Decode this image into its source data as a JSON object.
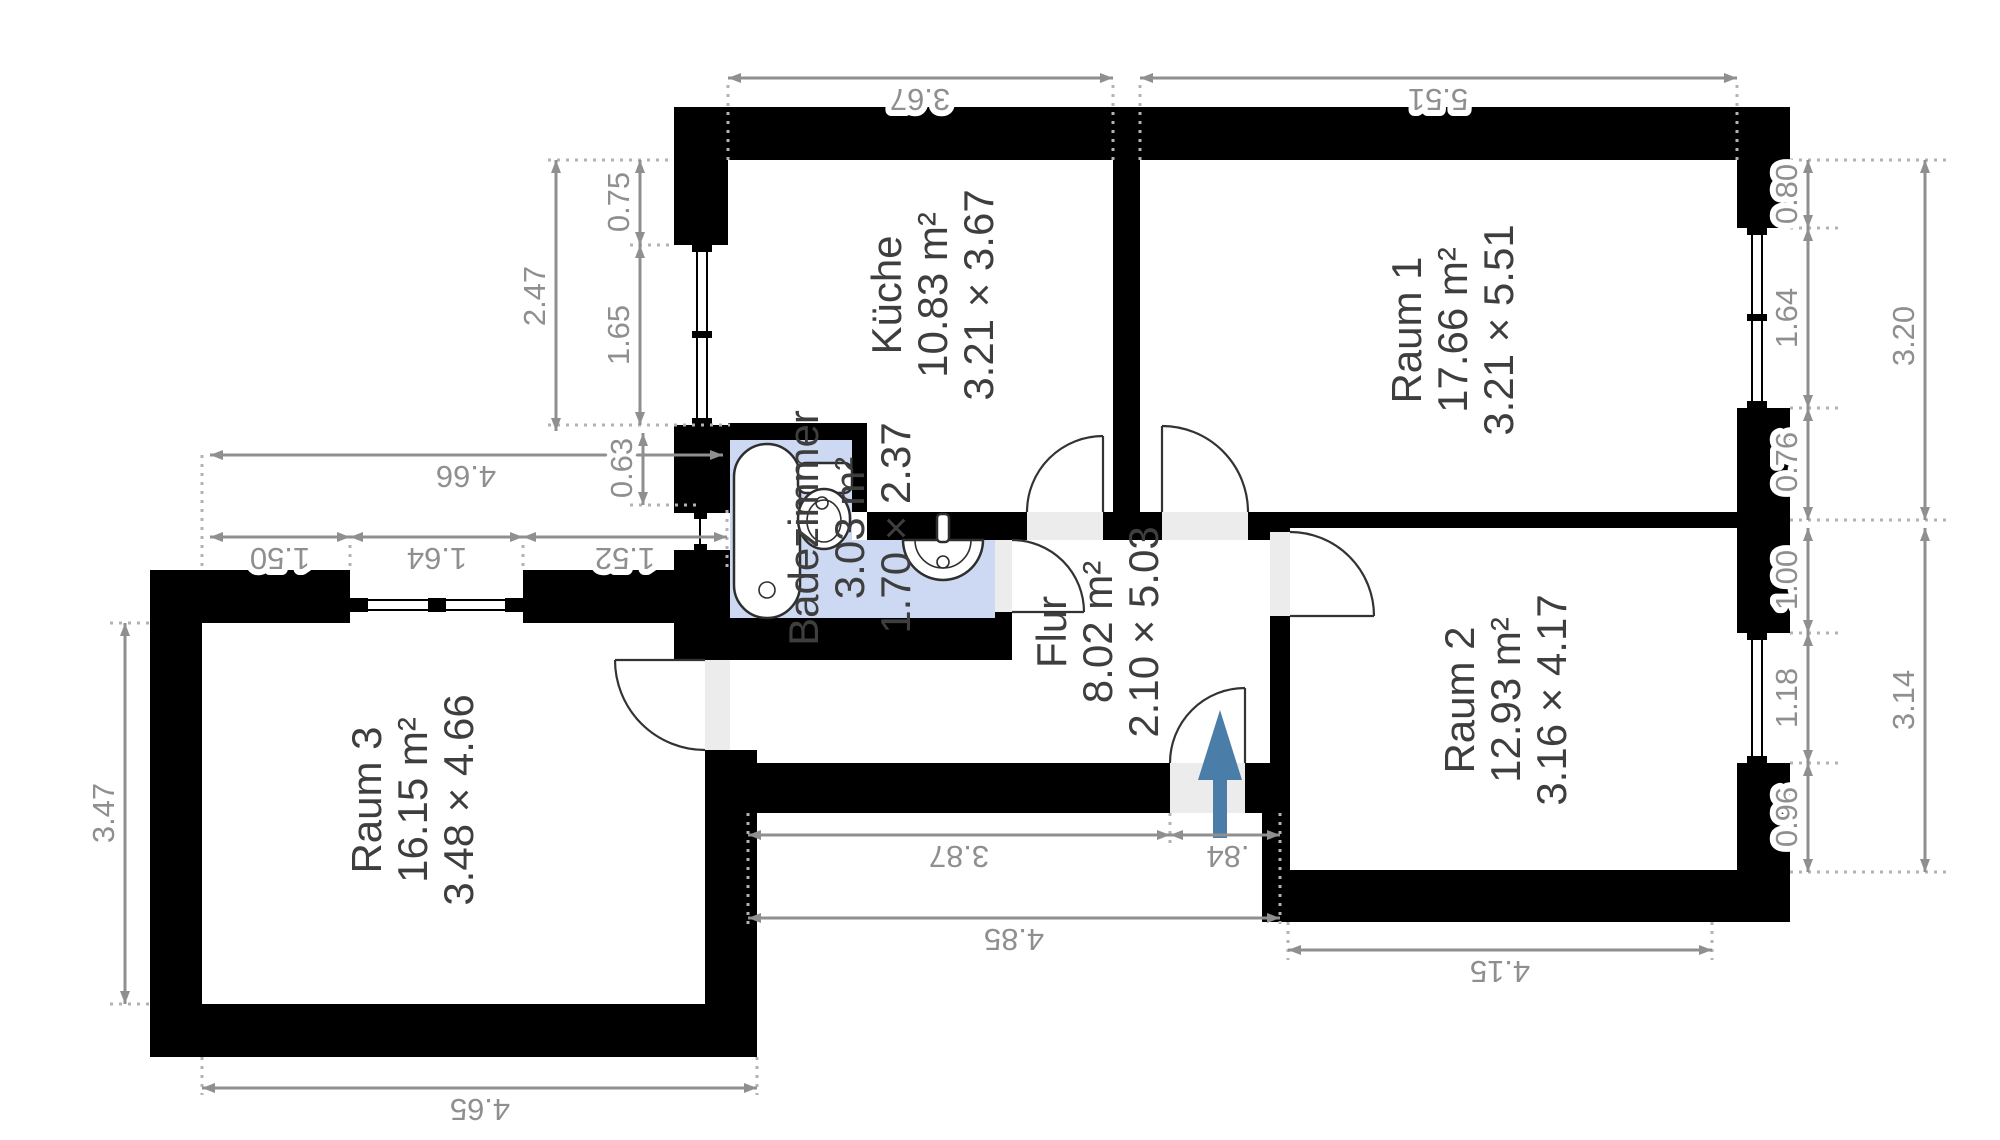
{
  "plan": {
    "type": "apartment-floor-plan",
    "units": "m",
    "colors": {
      "wall": "#000000",
      "bath_floor": "#cdd9f2",
      "entrance_arrow": "#4a7da8",
      "dimension_text": "#8f8f8f",
      "room_label": "#3e3e3e",
      "door_opening": "#ececec"
    }
  },
  "rooms": [
    {
      "id": "kueche",
      "name": "Küche",
      "area": "10.83 m²",
      "dims": "3.21 × 3.67"
    },
    {
      "id": "raum1",
      "name": "Raum 1",
      "area": "17.66 m²",
      "dims": "3.21 × 5.51"
    },
    {
      "id": "raum2",
      "name": "Raum 2",
      "area": "12.93 m²",
      "dims": "3.16 × 4.17"
    },
    {
      "id": "raum3",
      "name": "Raum 3",
      "area": "16.15 m²",
      "dims": "3.48 × 4.66"
    },
    {
      "id": "badezimmer",
      "name": "Badezimmer",
      "area": "3.03 m²",
      "dims": "1.70 × 2.37"
    },
    {
      "id": "flur",
      "name": "Flur",
      "area": "8.02 m²",
      "dims": "2.10 × 5.03"
    }
  ],
  "dims": {
    "v367": "3.67",
    "v551": "5.51",
    "v080": "0.80",
    "v164": "1.64",
    "v076": "0.76",
    "v320": "3.20",
    "v100": "1.00",
    "v118": "1.18",
    "v096": "0.96",
    "v314": "3.14",
    "v247": "2.47",
    "v075": "0.75",
    "v165": "1.65",
    "v063": "0.63",
    "v466": "4.66",
    "v150": "1.50",
    "v152": "1.52",
    "v347": "3.47",
    "v387": "3.87",
    "v084": ".84",
    "v485": "4.85",
    "v465": "4.65",
    "v415": "4.15"
  }
}
